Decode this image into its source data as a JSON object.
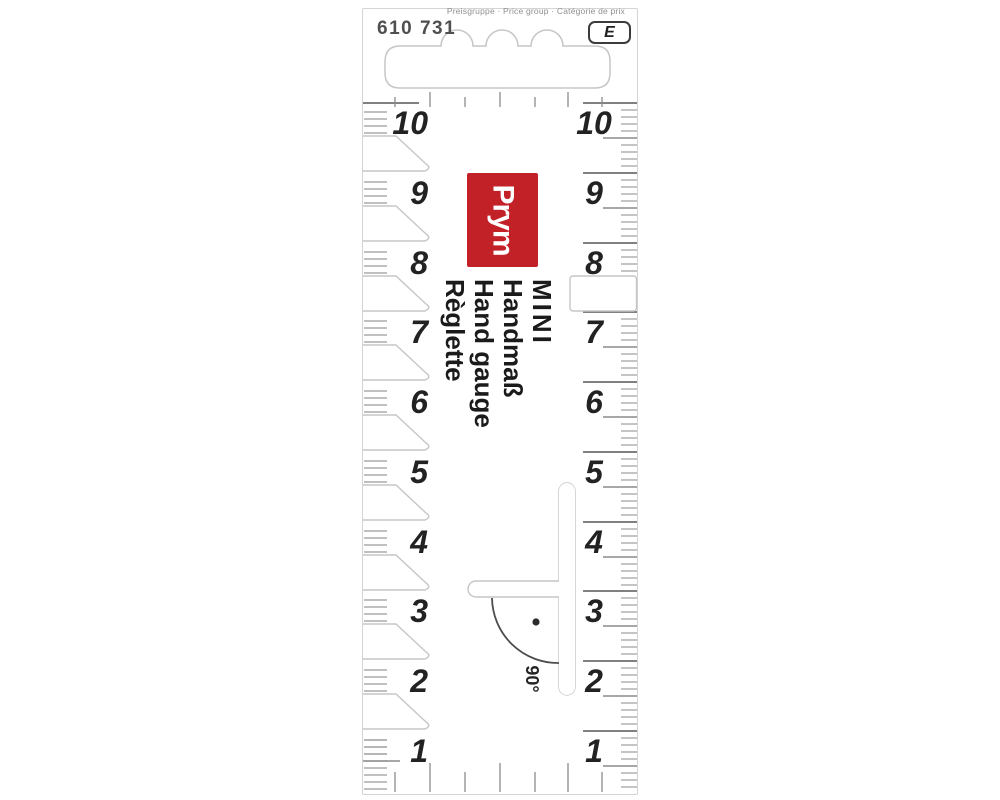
{
  "header": {
    "price_group_label": "Preisgruppe · Price group · Catégorie de prix",
    "article_number": "610 731",
    "price_group_code": "E"
  },
  "brand": {
    "name": "Prym",
    "logo_bg": "#c32128",
    "logo_text_color": "#ffffff"
  },
  "title": {
    "lines": [
      "MINI",
      "Handmaß",
      "Hand gauge",
      "Règlette"
    ]
  },
  "angle": {
    "label": "90°"
  },
  "scales": {
    "left": {
      "values": [
        "10",
        "9",
        "8",
        "7",
        "6",
        "5",
        "4",
        "3",
        "2",
        "1"
      ]
    },
    "right": {
      "values": [
        "10",
        "9",
        "8",
        "7",
        "6",
        "5",
        "4",
        "3",
        "2",
        "1"
      ]
    }
  }
}
